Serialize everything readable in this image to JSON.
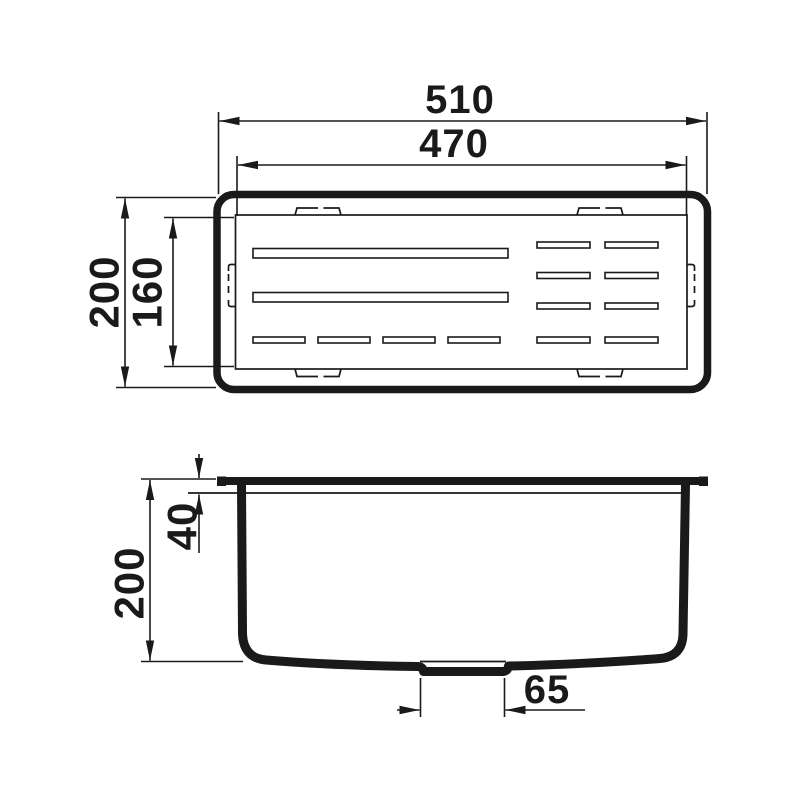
{
  "colors": {
    "ink": "#1a1a1a",
    "paper": "#ffffff"
  },
  "top_view": {
    "dims": {
      "outer_width": "510",
      "inner_width": "470",
      "outer_depth": "200",
      "inner_depth": "160"
    }
  },
  "side_view": {
    "dims": {
      "height": "200",
      "rim_depth": "40",
      "drain_width": "65"
    }
  }
}
